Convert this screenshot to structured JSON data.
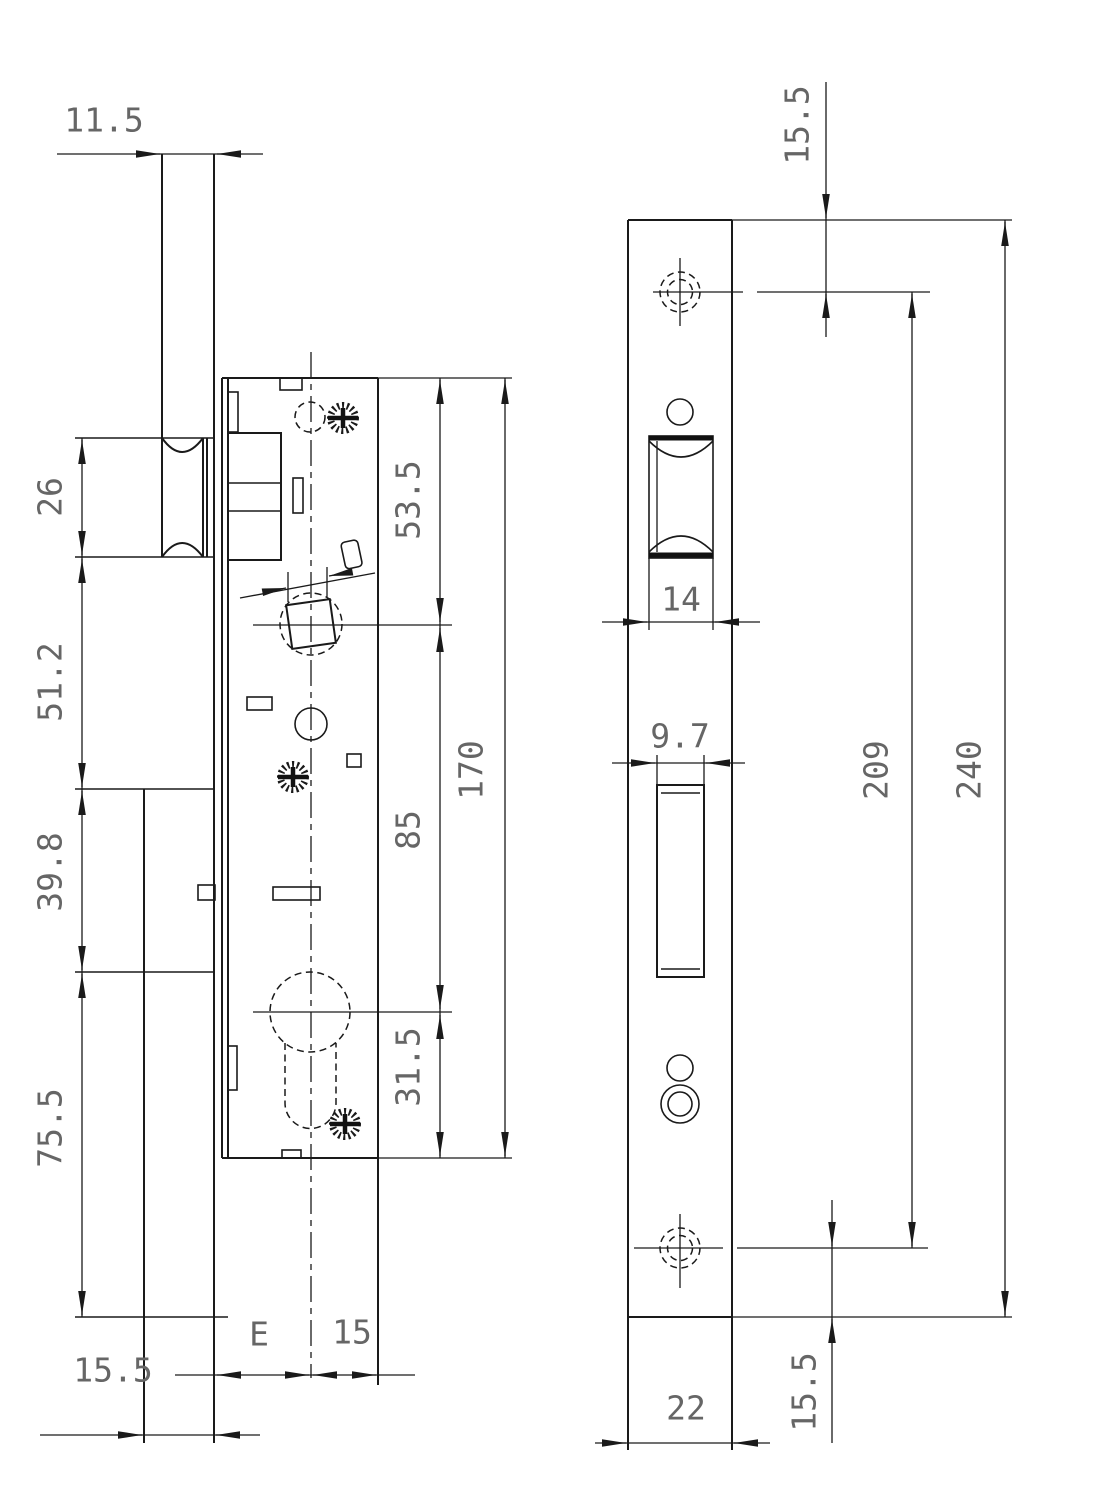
{
  "drawing": {
    "kind": "technical dimension drawing",
    "subject": "mortise lock case and strike plate",
    "units": "mm",
    "lock_view": {
      "dims": {
        "plate_top_depth": "11.5",
        "roller_height": "26",
        "roller_to_spindle_section": "51.2",
        "mid_section": "39.8",
        "lower_section": "75.5",
        "plate_bottom_depth": "15.5",
        "backset_label": "E",
        "behind_center": "15",
        "top_to_spindle": "53.5",
        "case_height": "170",
        "spindle_to_cylinder": "85",
        "cylinder_to_bottom": "31.5"
      }
    },
    "strike_view": {
      "dims": {
        "top_to_screw": "15.5",
        "roller_cutout_width": "14",
        "bolt_cutout_width": "9.7",
        "screw_centers": "209",
        "plate_height": "240",
        "bottom_to_screw": "15.5",
        "plate_width": "22"
      }
    }
  }
}
